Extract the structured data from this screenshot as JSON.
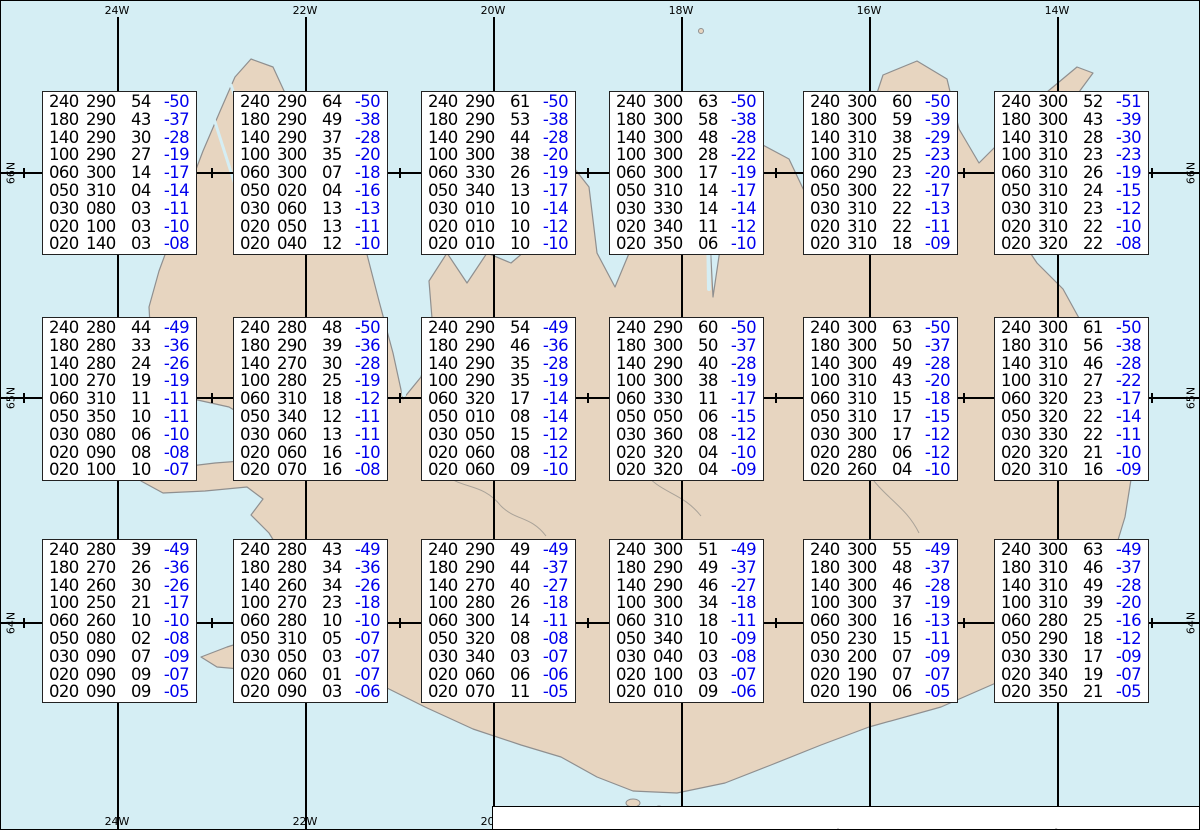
{
  "title": "Spot Chart UWC/IG-IS",
  "map": {
    "lon_labels": [
      "24W",
      "22W",
      "20W",
      "18W",
      "16W",
      "14W"
    ],
    "lat_labels": [
      "66N",
      "65N",
      "64N"
    ],
    "colors": {
      "water": "#d5eef4",
      "land": "#e7d5c0",
      "coast": "#8f8f8f",
      "grid": "#000000",
      "temp": "#0000ee"
    }
  },
  "footer": {
    "prefix": "Spot Chart: FL Dir KT °C ",
    "source_bold": "UWC/IG-IS:",
    "issue_text": " IT: Mán. 16. Feb. 2026 18Z ",
    "valid_bold": "VT: Mán. 16.02.2026 21Z",
    "suffix": " (+3 h)"
  },
  "chart_data": {
    "type": "table",
    "description": "Upper-air spot values over Iceland: each box lists flight level (FL), wind direction (deg true), wind speed (KT) and temperature (°C) at grid points; boxes arranged 6 columns x 3 rows.",
    "columns": [
      "FL",
      "Dir",
      "KT",
      "Temp"
    ],
    "grid": {
      "cols": 6,
      "rows": 3
    },
    "boxes": [
      {
        "row": 0,
        "col": 0,
        "values": [
          [
            "240",
            "290",
            "54",
            "-50"
          ],
          [
            "180",
            "290",
            "43",
            "-37"
          ],
          [
            "140",
            "290",
            "30",
            "-28"
          ],
          [
            "100",
            "290",
            "27",
            "-19"
          ],
          [
            "060",
            "300",
            "14",
            "-17"
          ],
          [
            "050",
            "310",
            "04",
            "-14"
          ],
          [
            "030",
            "080",
            "03",
            "-11"
          ],
          [
            "020",
            "100",
            "03",
            "-10"
          ],
          [
            "020",
            "140",
            "03",
            "-08"
          ]
        ]
      },
      {
        "row": 0,
        "col": 1,
        "values": [
          [
            "240",
            "290",
            "64",
            "-50"
          ],
          [
            "180",
            "290",
            "49",
            "-38"
          ],
          [
            "140",
            "290",
            "37",
            "-28"
          ],
          [
            "100",
            "300",
            "35",
            "-20"
          ],
          [
            "060",
            "300",
            "07",
            "-18"
          ],
          [
            "050",
            "020",
            "04",
            "-16"
          ],
          [
            "030",
            "060",
            "13",
            "-13"
          ],
          [
            "020",
            "050",
            "13",
            "-11"
          ],
          [
            "020",
            "040",
            "12",
            "-10"
          ]
        ]
      },
      {
        "row": 0,
        "col": 2,
        "values": [
          [
            "240",
            "290",
            "61",
            "-50"
          ],
          [
            "180",
            "290",
            "53",
            "-38"
          ],
          [
            "140",
            "290",
            "44",
            "-28"
          ],
          [
            "100",
            "300",
            "38",
            "-20"
          ],
          [
            "060",
            "330",
            "26",
            "-19"
          ],
          [
            "050",
            "340",
            "13",
            "-17"
          ],
          [
            "030",
            "010",
            "10",
            "-14"
          ],
          [
            "020",
            "010",
            "10",
            "-12"
          ],
          [
            "020",
            "010",
            "10",
            "-10"
          ]
        ]
      },
      {
        "row": 0,
        "col": 3,
        "values": [
          [
            "240",
            "300",
            "63",
            "-50"
          ],
          [
            "180",
            "300",
            "58",
            "-38"
          ],
          [
            "140",
            "300",
            "48",
            "-28"
          ],
          [
            "100",
            "300",
            "28",
            "-22"
          ],
          [
            "060",
            "300",
            "17",
            "-19"
          ],
          [
            "050",
            "310",
            "14",
            "-17"
          ],
          [
            "030",
            "330",
            "14",
            "-14"
          ],
          [
            "020",
            "340",
            "11",
            "-12"
          ],
          [
            "020",
            "350",
            "06",
            "-10"
          ]
        ]
      },
      {
        "row": 0,
        "col": 4,
        "values": [
          [
            "240",
            "300",
            "60",
            "-50"
          ],
          [
            "180",
            "300",
            "59",
            "-39"
          ],
          [
            "140",
            "310",
            "38",
            "-29"
          ],
          [
            "100",
            "310",
            "25",
            "-23"
          ],
          [
            "060",
            "290",
            "23",
            "-20"
          ],
          [
            "050",
            "300",
            "22",
            "-17"
          ],
          [
            "030",
            "310",
            "22",
            "-13"
          ],
          [
            "020",
            "310",
            "22",
            "-11"
          ],
          [
            "020",
            "310",
            "18",
            "-09"
          ]
        ]
      },
      {
        "row": 0,
        "col": 5,
        "values": [
          [
            "240",
            "300",
            "52",
            "-51"
          ],
          [
            "180",
            "300",
            "43",
            "-39"
          ],
          [
            "140",
            "310",
            "28",
            "-30"
          ],
          [
            "100",
            "310",
            "23",
            "-23"
          ],
          [
            "060",
            "310",
            "26",
            "-19"
          ],
          [
            "050",
            "310",
            "24",
            "-15"
          ],
          [
            "030",
            "310",
            "23",
            "-12"
          ],
          [
            "020",
            "310",
            "22",
            "-10"
          ],
          [
            "020",
            "320",
            "22",
            "-08"
          ]
        ]
      },
      {
        "row": 1,
        "col": 0,
        "values": [
          [
            "240",
            "280",
            "44",
            "-49"
          ],
          [
            "180",
            "280",
            "33",
            "-36"
          ],
          [
            "140",
            "280",
            "24",
            "-26"
          ],
          [
            "100",
            "270",
            "19",
            "-19"
          ],
          [
            "060",
            "310",
            "11",
            "-11"
          ],
          [
            "050",
            "350",
            "10",
            "-11"
          ],
          [
            "030",
            "080",
            "06",
            "-10"
          ],
          [
            "020",
            "090",
            "08",
            "-08"
          ],
          [
            "020",
            "100",
            "10",
            "-07"
          ]
        ]
      },
      {
        "row": 1,
        "col": 1,
        "values": [
          [
            "240",
            "280",
            "48",
            "-50"
          ],
          [
            "180",
            "290",
            "39",
            "-36"
          ],
          [
            "140",
            "270",
            "30",
            "-28"
          ],
          [
            "100",
            "280",
            "25",
            "-19"
          ],
          [
            "060",
            "310",
            "18",
            "-12"
          ],
          [
            "050",
            "340",
            "12",
            "-11"
          ],
          [
            "030",
            "060",
            "13",
            "-11"
          ],
          [
            "020",
            "060",
            "16",
            "-10"
          ],
          [
            "020",
            "070",
            "16",
            "-08"
          ]
        ]
      },
      {
        "row": 1,
        "col": 2,
        "values": [
          [
            "240",
            "290",
            "54",
            "-49"
          ],
          [
            "180",
            "290",
            "46",
            "-36"
          ],
          [
            "140",
            "290",
            "35",
            "-28"
          ],
          [
            "100",
            "290",
            "35",
            "-19"
          ],
          [
            "060",
            "320",
            "17",
            "-14"
          ],
          [
            "050",
            "010",
            "08",
            "-14"
          ],
          [
            "030",
            "050",
            "15",
            "-12"
          ],
          [
            "020",
            "060",
            "08",
            "-12"
          ],
          [
            "020",
            "060",
            "09",
            "-10"
          ]
        ]
      },
      {
        "row": 1,
        "col": 3,
        "values": [
          [
            "240",
            "290",
            "60",
            "-50"
          ],
          [
            "180",
            "300",
            "50",
            "-37"
          ],
          [
            "140",
            "290",
            "40",
            "-28"
          ],
          [
            "100",
            "300",
            "38",
            "-19"
          ],
          [
            "060",
            "330",
            "11",
            "-17"
          ],
          [
            "050",
            "050",
            "06",
            "-15"
          ],
          [
            "030",
            "360",
            "08",
            "-12"
          ],
          [
            "020",
            "320",
            "04",
            "-10"
          ],
          [
            "020",
            "320",
            "04",
            "-09"
          ]
        ]
      },
      {
        "row": 1,
        "col": 4,
        "values": [
          [
            "240",
            "300",
            "63",
            "-50"
          ],
          [
            "180",
            "300",
            "50",
            "-37"
          ],
          [
            "140",
            "300",
            "49",
            "-28"
          ],
          [
            "100",
            "310",
            "43",
            "-20"
          ],
          [
            "060",
            "310",
            "15",
            "-18"
          ],
          [
            "050",
            "310",
            "17",
            "-15"
          ],
          [
            "030",
            "300",
            "17",
            "-12"
          ],
          [
            "020",
            "280",
            "06",
            "-12"
          ],
          [
            "020",
            "260",
            "04",
            "-10"
          ]
        ]
      },
      {
        "row": 1,
        "col": 5,
        "values": [
          [
            "240",
            "300",
            "61",
            "-50"
          ],
          [
            "180",
            "310",
            "56",
            "-38"
          ],
          [
            "140",
            "310",
            "46",
            "-28"
          ],
          [
            "100",
            "310",
            "27",
            "-22"
          ],
          [
            "060",
            "320",
            "23",
            "-17"
          ],
          [
            "050",
            "320",
            "22",
            "-14"
          ],
          [
            "030",
            "330",
            "22",
            "-11"
          ],
          [
            "020",
            "320",
            "21",
            "-10"
          ],
          [
            "020",
            "310",
            "16",
            "-09"
          ]
        ]
      },
      {
        "row": 2,
        "col": 0,
        "values": [
          [
            "240",
            "280",
            "39",
            "-49"
          ],
          [
            "180",
            "270",
            "26",
            "-36"
          ],
          [
            "140",
            "260",
            "30",
            "-26"
          ],
          [
            "100",
            "250",
            "21",
            "-17"
          ],
          [
            "060",
            "260",
            "10",
            "-10"
          ],
          [
            "050",
            "080",
            "02",
            "-08"
          ],
          [
            "030",
            "090",
            "07",
            "-09"
          ],
          [
            "020",
            "090",
            "09",
            "-07"
          ],
          [
            "020",
            "090",
            "09",
            "-05"
          ]
        ]
      },
      {
        "row": 2,
        "col": 1,
        "values": [
          [
            "240",
            "280",
            "43",
            "-49"
          ],
          [
            "180",
            "280",
            "34",
            "-36"
          ],
          [
            "140",
            "260",
            "34",
            "-26"
          ],
          [
            "100",
            "270",
            "23",
            "-18"
          ],
          [
            "060",
            "280",
            "10",
            "-10"
          ],
          [
            "050",
            "310",
            "05",
            "-07"
          ],
          [
            "030",
            "050",
            "03",
            "-07"
          ],
          [
            "020",
            "060",
            "01",
            "-07"
          ],
          [
            "020",
            "090",
            "03",
            "-06"
          ]
        ]
      },
      {
        "row": 2,
        "col": 2,
        "values": [
          [
            "240",
            "290",
            "49",
            "-49"
          ],
          [
            "180",
            "290",
            "44",
            "-37"
          ],
          [
            "140",
            "270",
            "40",
            "-27"
          ],
          [
            "100",
            "280",
            "26",
            "-18"
          ],
          [
            "060",
            "300",
            "14",
            "-11"
          ],
          [
            "050",
            "320",
            "08",
            "-08"
          ],
          [
            "030",
            "340",
            "03",
            "-07"
          ],
          [
            "020",
            "060",
            "06",
            "-06"
          ],
          [
            "020",
            "070",
            "11",
            "-05"
          ]
        ]
      },
      {
        "row": 2,
        "col": 3,
        "values": [
          [
            "240",
            "300",
            "51",
            "-49"
          ],
          [
            "180",
            "290",
            "49",
            "-37"
          ],
          [
            "140",
            "290",
            "46",
            "-27"
          ],
          [
            "100",
            "300",
            "34",
            "-18"
          ],
          [
            "060",
            "310",
            "18",
            "-11"
          ],
          [
            "050",
            "340",
            "10",
            "-09"
          ],
          [
            "030",
            "040",
            "03",
            "-08"
          ],
          [
            "020",
            "100",
            "03",
            "-07"
          ],
          [
            "020",
            "010",
            "09",
            "-06"
          ]
        ]
      },
      {
        "row": 2,
        "col": 4,
        "values": [
          [
            "240",
            "300",
            "55",
            "-49"
          ],
          [
            "180",
            "300",
            "48",
            "-37"
          ],
          [
            "140",
            "300",
            "46",
            "-28"
          ],
          [
            "100",
            "300",
            "37",
            "-19"
          ],
          [
            "060",
            "300",
            "16",
            "-13"
          ],
          [
            "050",
            "230",
            "15",
            "-11"
          ],
          [
            "030",
            "200",
            "07",
            "-09"
          ],
          [
            "020",
            "190",
            "07",
            "-07"
          ],
          [
            "020",
            "190",
            "06",
            "-05"
          ]
        ]
      },
      {
        "row": 2,
        "col": 5,
        "values": [
          [
            "240",
            "300",
            "63",
            "-49"
          ],
          [
            "180",
            "310",
            "46",
            "-37"
          ],
          [
            "140",
            "310",
            "49",
            "-28"
          ],
          [
            "100",
            "310",
            "39",
            "-20"
          ],
          [
            "060",
            "280",
            "25",
            "-16"
          ],
          [
            "050",
            "290",
            "18",
            "-12"
          ],
          [
            "030",
            "330",
            "17",
            "-09"
          ],
          [
            "020",
            "340",
            "19",
            "-07"
          ],
          [
            "020",
            "350",
            "21",
            "-05"
          ]
        ]
      }
    ]
  }
}
